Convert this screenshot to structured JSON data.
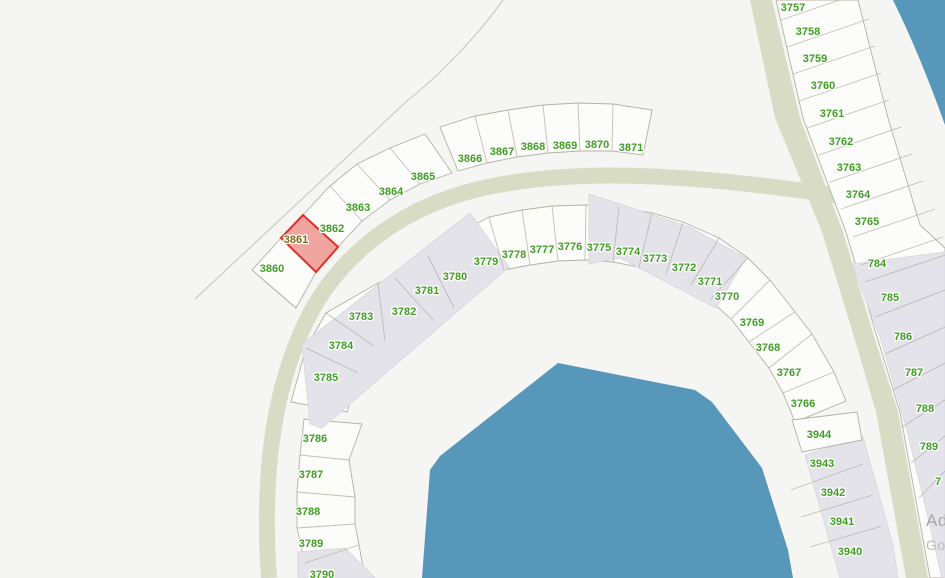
{
  "map": {
    "colors": {
      "background": "#f5f5f3",
      "parcel_fill": "#fcfcfa",
      "parcel_stroke": "#b3b1a4",
      "road": "#d9dcc5",
      "building": "#e4e3ea",
      "building_stroke": "#d7d6de",
      "water": "#5797ba",
      "label_green": "#3f9e23",
      "highlight_fill": "#f0a5a0",
      "highlight_stroke": "#e03228",
      "highlight_label": "#7d6b21",
      "boundary_line": "#cbcbc6"
    },
    "highlighted_parcel": {
      "id": "3861"
    },
    "watermark": {
      "line1": "Ad",
      "line2": "Go"
    },
    "parcel_labels": [
      {
        "t": "3860",
        "x": 272,
        "y": 268
      },
      {
        "t": "3861",
        "x": 296,
        "y": 239,
        "hl": true
      },
      {
        "t": "3862",
        "x": 332,
        "y": 228
      },
      {
        "t": "3863",
        "x": 358,
        "y": 207
      },
      {
        "t": "3864",
        "x": 391,
        "y": 191
      },
      {
        "t": "3865",
        "x": 423,
        "y": 176
      },
      {
        "t": "3866",
        "x": 470,
        "y": 158
      },
      {
        "t": "3867",
        "x": 502,
        "y": 151
      },
      {
        "t": "3868",
        "x": 533,
        "y": 146
      },
      {
        "t": "3869",
        "x": 565,
        "y": 145
      },
      {
        "t": "3870",
        "x": 597,
        "y": 144
      },
      {
        "t": "3871",
        "x": 631,
        "y": 147
      },
      {
        "t": "3779",
        "x": 486,
        "y": 261
      },
      {
        "t": "3778",
        "x": 514,
        "y": 254
      },
      {
        "t": "3777",
        "x": 542,
        "y": 249
      },
      {
        "t": "3776",
        "x": 570,
        "y": 246
      },
      {
        "t": "3775",
        "x": 599,
        "y": 247
      },
      {
        "t": "3774",
        "x": 628,
        "y": 251
      },
      {
        "t": "3773",
        "x": 655,
        "y": 258
      },
      {
        "t": "3772",
        "x": 684,
        "y": 267
      },
      {
        "t": "3771",
        "x": 710,
        "y": 281
      },
      {
        "t": "3770",
        "x": 727,
        "y": 296
      },
      {
        "t": "3769",
        "x": 752,
        "y": 322
      },
      {
        "t": "3768",
        "x": 768,
        "y": 347
      },
      {
        "t": "3767",
        "x": 789,
        "y": 372
      },
      {
        "t": "3766",
        "x": 803,
        "y": 403
      },
      {
        "t": "3780",
        "x": 455,
        "y": 276
      },
      {
        "t": "3781",
        "x": 427,
        "y": 290
      },
      {
        "t": "3782",
        "x": 404,
        "y": 311
      },
      {
        "t": "3783",
        "x": 361,
        "y": 316
      },
      {
        "t": "3784",
        "x": 341,
        "y": 345
      },
      {
        "t": "3785",
        "x": 326,
        "y": 377
      },
      {
        "t": "3786",
        "x": 315,
        "y": 438
      },
      {
        "t": "3787",
        "x": 311,
        "y": 474
      },
      {
        "t": "3788",
        "x": 308,
        "y": 511
      },
      {
        "t": "3789",
        "x": 311,
        "y": 543
      },
      {
        "t": "3790",
        "x": 322,
        "y": 574
      },
      {
        "t": "3757",
        "x": 793,
        "y": 7
      },
      {
        "t": "3758",
        "x": 808,
        "y": 31
      },
      {
        "t": "3759",
        "x": 815,
        "y": 58
      },
      {
        "t": "3760",
        "x": 823,
        "y": 85
      },
      {
        "t": "3761",
        "x": 832,
        "y": 113
      },
      {
        "t": "3762",
        "x": 841,
        "y": 141
      },
      {
        "t": "3763",
        "x": 849,
        "y": 167
      },
      {
        "t": "3764",
        "x": 858,
        "y": 194
      },
      {
        "t": "3765",
        "x": 867,
        "y": 221
      },
      {
        "t": "784",
        "x": 877,
        "y": 263
      },
      {
        "t": "785",
        "x": 890,
        "y": 297
      },
      {
        "t": "786",
        "x": 903,
        "y": 336
      },
      {
        "t": "787",
        "x": 914,
        "y": 372
      },
      {
        "t": "788",
        "x": 925,
        "y": 408
      },
      {
        "t": "789",
        "x": 929,
        "y": 446
      },
      {
        "t": "7",
        "x": 938,
        "y": 481
      },
      {
        "t": "3944",
        "x": 819,
        "y": 434
      },
      {
        "t": "3943",
        "x": 822,
        "y": 463
      },
      {
        "t": "3942",
        "x": 833,
        "y": 492
      },
      {
        "t": "3941",
        "x": 842,
        "y": 521
      },
      {
        "t": "3940",
        "x": 850,
        "y": 551
      }
    ]
  }
}
